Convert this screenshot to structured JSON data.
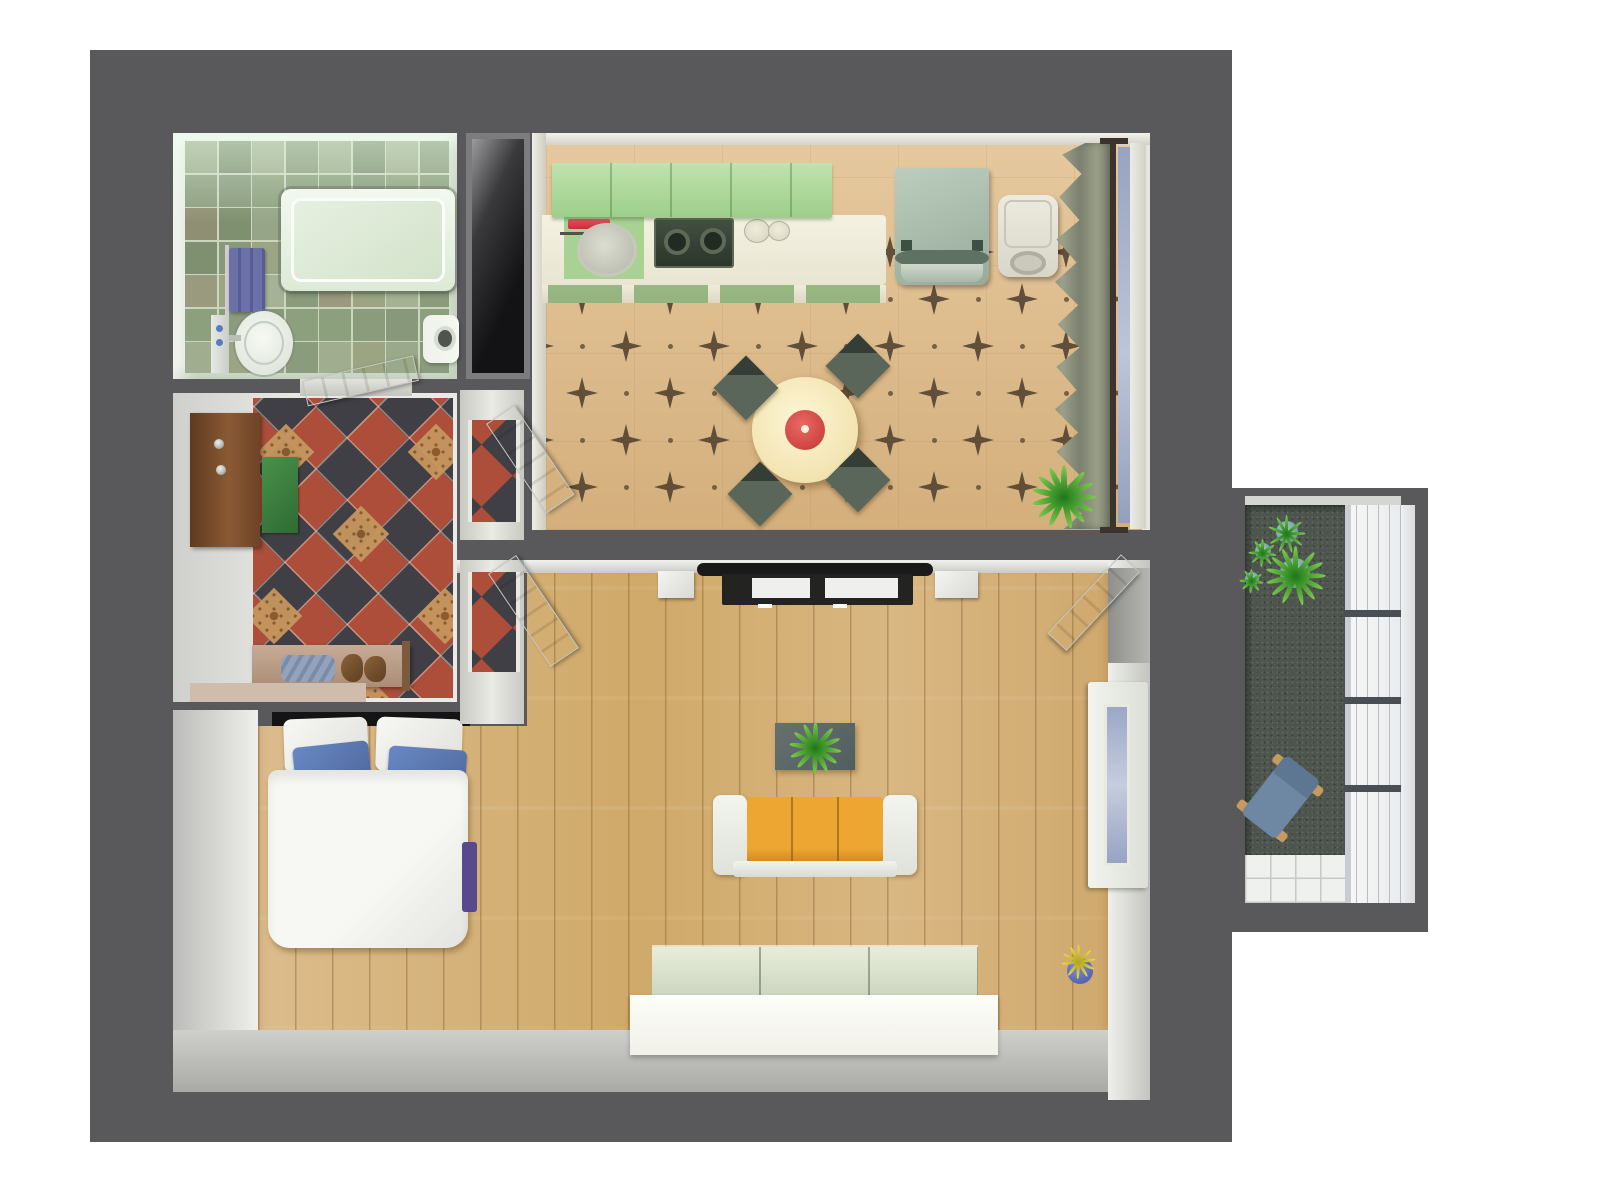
{
  "meta": {
    "title": "3D apartment floor plan — top-down render",
    "render_style": "architectural 3D visualization, bird's-eye view",
    "background": "#ffffff"
  },
  "palette": {
    "exterior_walls": "#59595b",
    "wall_faces": "#e6e6e2",
    "wood_floor": "#d7b47e",
    "kitchen_floor": "#ddbe92",
    "kitchen_star_motif": "#50402f",
    "bathroom_tile": "#93a283",
    "hall_tile_red": "#ac4e3a",
    "hall_tile_charcoal": "#403f46",
    "hall_tile_gold": "#c6975f",
    "kitchen_cabinets": "#abd698",
    "counter_cream": "#f1eedd",
    "accent_red": "#e0404f",
    "sofa_orange": "#e29a2f",
    "pillow_blue": "#5f7cb8",
    "duvet_white": "#f4f4f0",
    "balcony_floor": "#4d554e",
    "glass_blue": "#a3aec9",
    "plant_green": "#2f8a25"
  },
  "rooms": {
    "bathroom": {
      "label": "Bathroom",
      "floor": "sage green ceramic tiles",
      "items": [
        "bathtub",
        "towel rail with purple towel",
        "washbasin with tap",
        "mirror shelf with cups",
        "toilet"
      ]
    },
    "shaft": {
      "label": "Installation shaft"
    },
    "hallway": {
      "label": "Entrance hall",
      "floor": "diagonal red, charcoal and ornamented gold tiles",
      "items": [
        "wooden entrance door with knobs",
        "green doormat",
        "shoe bench with shoes and blue cloth",
        "beige runner mat",
        "open white interior doors"
      ]
    },
    "kitchen": {
      "label": "Kitchen and dining room",
      "floor": "beige tiles with dark four-point star motifs",
      "items": [
        "green upper cabinets",
        "counter with round sink",
        "red kitchen towel",
        "two-burner hob",
        "plates",
        "green base drawers",
        "refrigerator",
        "washing machine",
        "curtained window",
        "round dining table with red bowl",
        "four dark chairs",
        "potted plant"
      ]
    },
    "living_room": {
      "label": "Living room and bedroom",
      "floor": "oak plank flooring",
      "items": [
        "tv lowboard with two screens",
        "two white speakers",
        "coffee table with houseplant",
        "orange three-seat sofa",
        "double bed with white duvet and blue pillows",
        "purple bed runner",
        "white wardrobe",
        "blue vase with yellow flowers",
        "window",
        "open balcony door"
      ]
    },
    "balcony": {
      "label": "Balcony",
      "floor": "dark green outdoor carpet with white tile strip",
      "items": [
        "four potted plants",
        "wooden chair with blue cushion",
        "full-height glazing with three transoms"
      ]
    }
  }
}
